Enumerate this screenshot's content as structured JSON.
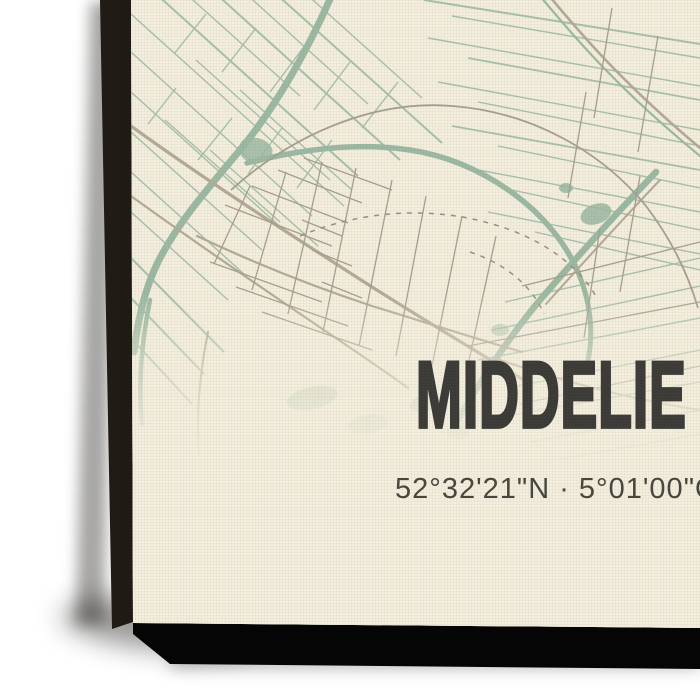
{
  "product": {
    "title": "MIDDELIE",
    "coordinates": "52°32'21\"N · 5°01'00\"O"
  },
  "canvas": {
    "colors": {
      "paper": "#f3eedd",
      "ditch": "#a4bea9",
      "canal": "#9cb9a3",
      "road": "#b3aa97",
      "street": "#a79f90",
      "dashed": "#9a9183",
      "title_text": "#3b3a37",
      "coords_text": "#46463f",
      "side_edge": "#17130e",
      "bottom_edge": "#0b0a09"
    }
  }
}
